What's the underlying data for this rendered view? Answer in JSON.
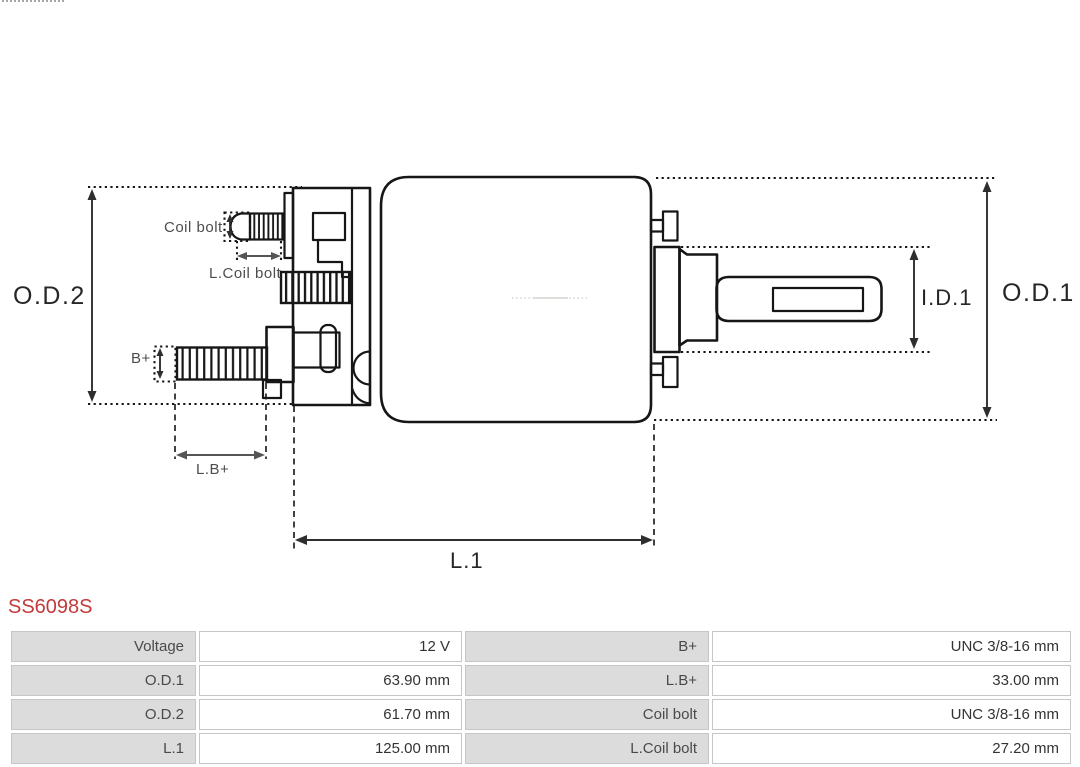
{
  "part": {
    "number": "SS6098S",
    "accent_color": "#c43a3a"
  },
  "diagram": {
    "line_color": "#161616",
    "labels": {
      "od2": "O.D.2",
      "od1": "O.D.1",
      "id1": "I.D.1",
      "l1": "L.1",
      "coil_bolt": "Coil bolt",
      "l_coil_bolt": "L.Coil bolt",
      "b_plus": "B+",
      "l_b_plus": "L.B+"
    }
  },
  "spec_table": {
    "label_bg": "#dcdcdc",
    "border_color": "#c6c6c6",
    "rows": [
      {
        "label1": "Voltage",
        "value1": "12 V",
        "label2": "B+",
        "value2": "UNC 3/8-16 mm"
      },
      {
        "label1": "O.D.1",
        "value1": "63.90 mm",
        "label2": "L.B+",
        "value2": "33.00 mm"
      },
      {
        "label1": "O.D.2",
        "value1": "61.70 mm",
        "label2": "Coil bolt",
        "value2": "UNC 3/8-16 mm"
      },
      {
        "label1": "L.1",
        "value1": "125.00 mm",
        "label2": "L.Coil bolt",
        "value2": "27.20 mm"
      }
    ]
  }
}
